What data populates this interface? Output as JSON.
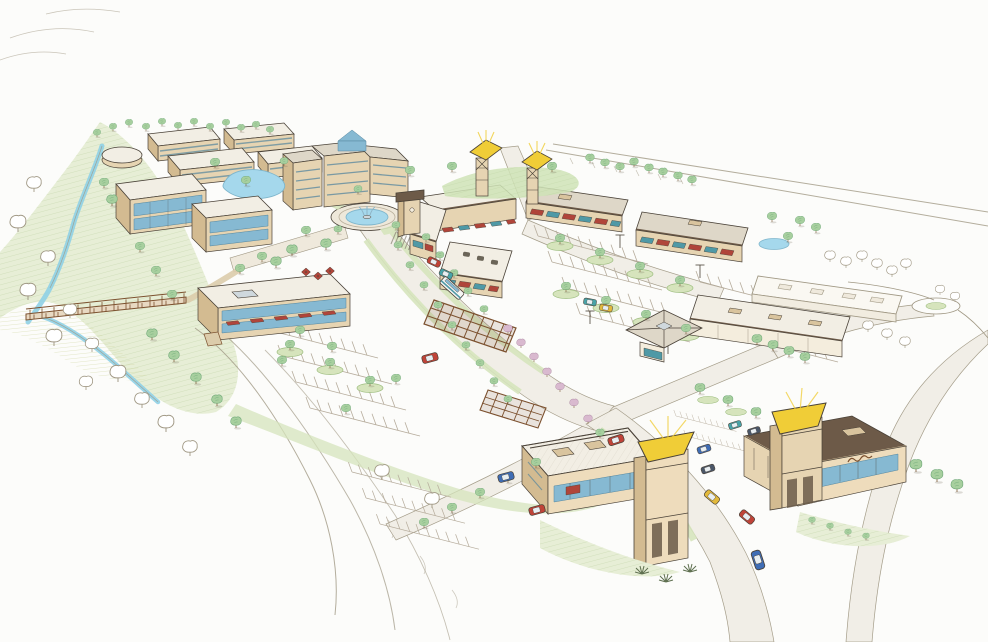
{
  "meta": {
    "title": "Aerial concept sketch of a mixed-use town center development",
    "medium": "hand-drawn colored-pencil rendering on white paper",
    "view": "bird's-eye perspective from the southwest"
  },
  "colors": {
    "paper": "#fcfcfa",
    "line": "#4a4238",
    "faint": "#a09884",
    "stripe": "#b6ac9c",
    "grass": "#d6e4bc",
    "grass_dark": "#9dbd7f",
    "grass_light": "#e7eed6",
    "scrub": "#cdd29a",
    "tree": "#a7cf9e",
    "tree_dark": "#6fa878",
    "tree_light": "#cfe3b6",
    "trunk": "#7c5a36",
    "flower_pink": "#d9b9cf",
    "flower_edge": "#a987a0",
    "creek": "#8fd0e6",
    "creek_dark": "#5fb3d4",
    "pond": "#a5d8ec",
    "pond_edge": "#7fb6cc",
    "road": "#f1eee6",
    "path": "#dcccab",
    "wall_tan": "#e6d4b2",
    "wall_shade": "#d3bb91",
    "wall_peach": "#eedcbc",
    "wall_light": "#f4eddd",
    "roof_white": "#f2eee4",
    "roof_gray": "#ded7c8",
    "roof_dark": "#6d5a48",
    "parapet_tan": "#d9c49e",
    "awning_red": "#b0453a",
    "awning_teal": "#4f99a6",
    "glass": "#86b9d2",
    "glass_dark": "#55869e",
    "wood": "#7c512f",
    "canopy_yellow": "#f0cd37",
    "car_red": "#c04338",
    "car_blue": "#3f6db5",
    "car_teal": "#48a3a8",
    "car_yellow": "#e2b93b",
    "car_dark": "#4a5668"
  },
  "scene": {
    "landscape": {
      "creek": {
        "label": "winding blue creek in a green riparian corridor"
      },
      "bridge": {
        "label": "timber pedestrian bridge crossing the creek"
      },
      "meadow": {
        "label": "open meadow and sketched berm along the south edge"
      }
    },
    "water_features": {
      "fountain_plaza": {
        "label": "oval fountain pond in the central roundabout"
      },
      "hotel_pond": {
        "label": "amenity pond in front of the hotel"
      },
      "retail_pond": {
        "label": "small pond east of the shop strips"
      }
    },
    "buildings": {
      "apartments": {
        "label": "residential blocks in the northwest cluster",
        "count": 5
      },
      "office_glass": {
        "label": "three-story office with blue glass curtain wall"
      },
      "hotel": {
        "label": "five-story hotel with central glass atrium gable"
      },
      "office_mixed_use": {
        "label": "two-story office over retail with red awnings and cafe terrace"
      },
      "office_small": {
        "label": "three-story office building"
      },
      "main_street_retail": {
        "label": "L-shaped main-street retail with clock tower and red and teal awnings"
      },
      "shops_north_1": {
        "label": "retail strip with storefront awnings"
      },
      "shops_north_2": {
        "label": "retail strip with storefront awnings"
      },
      "junior_anchor": {
        "label": "anchor store with pyramidal entry rotunda"
      },
      "big_box": {
        "label": "large retail building with rooftop units"
      },
      "corner_retail_west": {
        "label": "retail building with yellow-canopy corner tower"
      },
      "corner_retail_east": {
        "label": "retail building with yellow-canopy corner tower and cursive script sign"
      },
      "gateway_towers": {
        "label": "pair of open-frame gateway pylons with yellow canopies",
        "count": 2
      }
    },
    "streetscape": {
      "roundabout": {
        "label": "landscaped fountain roundabout"
      },
      "main_street": {
        "label": "tree-lined main street with flowering-tree median"
      },
      "trellis": {
        "label": "timber trellis spanning the main street",
        "count": 2
      },
      "parking": {
        "label": "surface parking fields with planted islands and light poles"
      },
      "crosswalk": {
        "label": "paver crosswalk at the roundabout"
      }
    },
    "vehicles": {
      "label": "scattered cars and one shuttle bus",
      "cars": [
        "red",
        "red",
        "teal",
        "teal",
        "yellow",
        "red",
        "blue",
        "red",
        "yellow",
        "red",
        "blue",
        "blue",
        "dark",
        "teal",
        "dark"
      ],
      "shuttle": "white with teal stripe"
    },
    "signage": {
      "script_sign": {
        "label": "illegible cursive storefront sign",
        "legible": false
      }
    }
  }
}
